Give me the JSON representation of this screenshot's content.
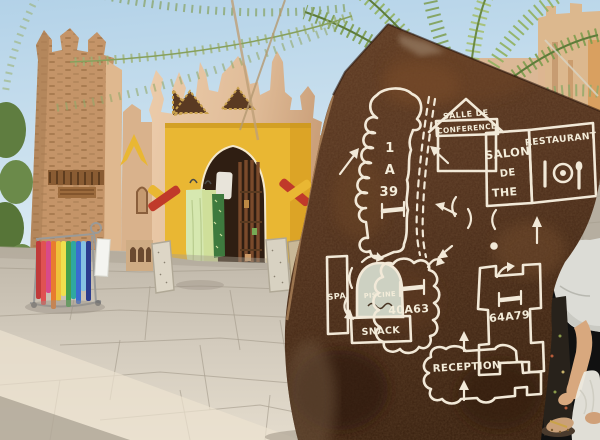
{
  "sign": {
    "rooms_1_39": {
      "line1": "1",
      "line2": "A",
      "line3": "39"
    },
    "conference": {
      "line1": "SALLE DE",
      "line2": "CONFERENCE"
    },
    "salon": {
      "line1": "SALON",
      "line2": "DE",
      "line3": "THE"
    },
    "restaurant": {
      "label": "RESTAURANT"
    },
    "spa": {
      "label": "SPA"
    },
    "piscine": {
      "label": "PISCINE"
    },
    "snack": {
      "label": "SNACK"
    },
    "rooms_40_63": {
      "label": "40A63"
    },
    "rooms_64_79": {
      "label": "64A79"
    },
    "reception": {
      "label": "RECEPTION"
    }
  },
  "icons": {
    "bed": "bed-icon",
    "dining": "plate-and-cutlery-icon",
    "swimmer": "swimmer-icon",
    "arrow": "direction-arrow-icon",
    "walkway": "dashed-path-icon"
  },
  "colors": {
    "stone_brown": "#4e2e1b",
    "paint_white": "#f2e9d8",
    "portal_yellow": "#e9b733",
    "wall_tan": "#d9b28c",
    "sky_blue": "#bcd8ea",
    "palm_green": "#85a456",
    "pavement_grey": "#cdc5b7"
  }
}
